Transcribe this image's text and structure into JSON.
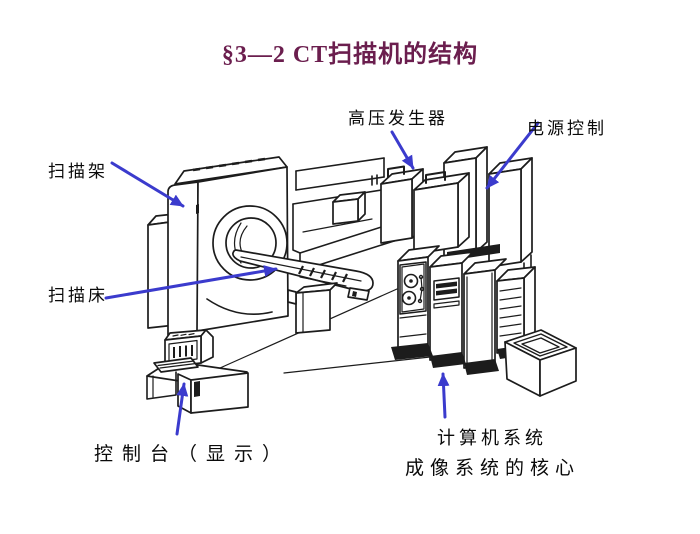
{
  "slide": {
    "title": "§3—2 CT扫描机的结构"
  },
  "annotations": {
    "gantry": "扫描架",
    "hv_generator": "高压发生器",
    "power_control": "电源控制",
    "scan_bed": "扫描床",
    "console": "控制台（显示）",
    "computer_system": "计算机系统",
    "computer_system_note": "成像系统的核心"
  },
  "colors": {
    "title": "#6b1e4e",
    "label": "#0a0a0a",
    "arrow": "#3b3bcd",
    "line": "#1c1c1c",
    "background": "#ffffff"
  }
}
